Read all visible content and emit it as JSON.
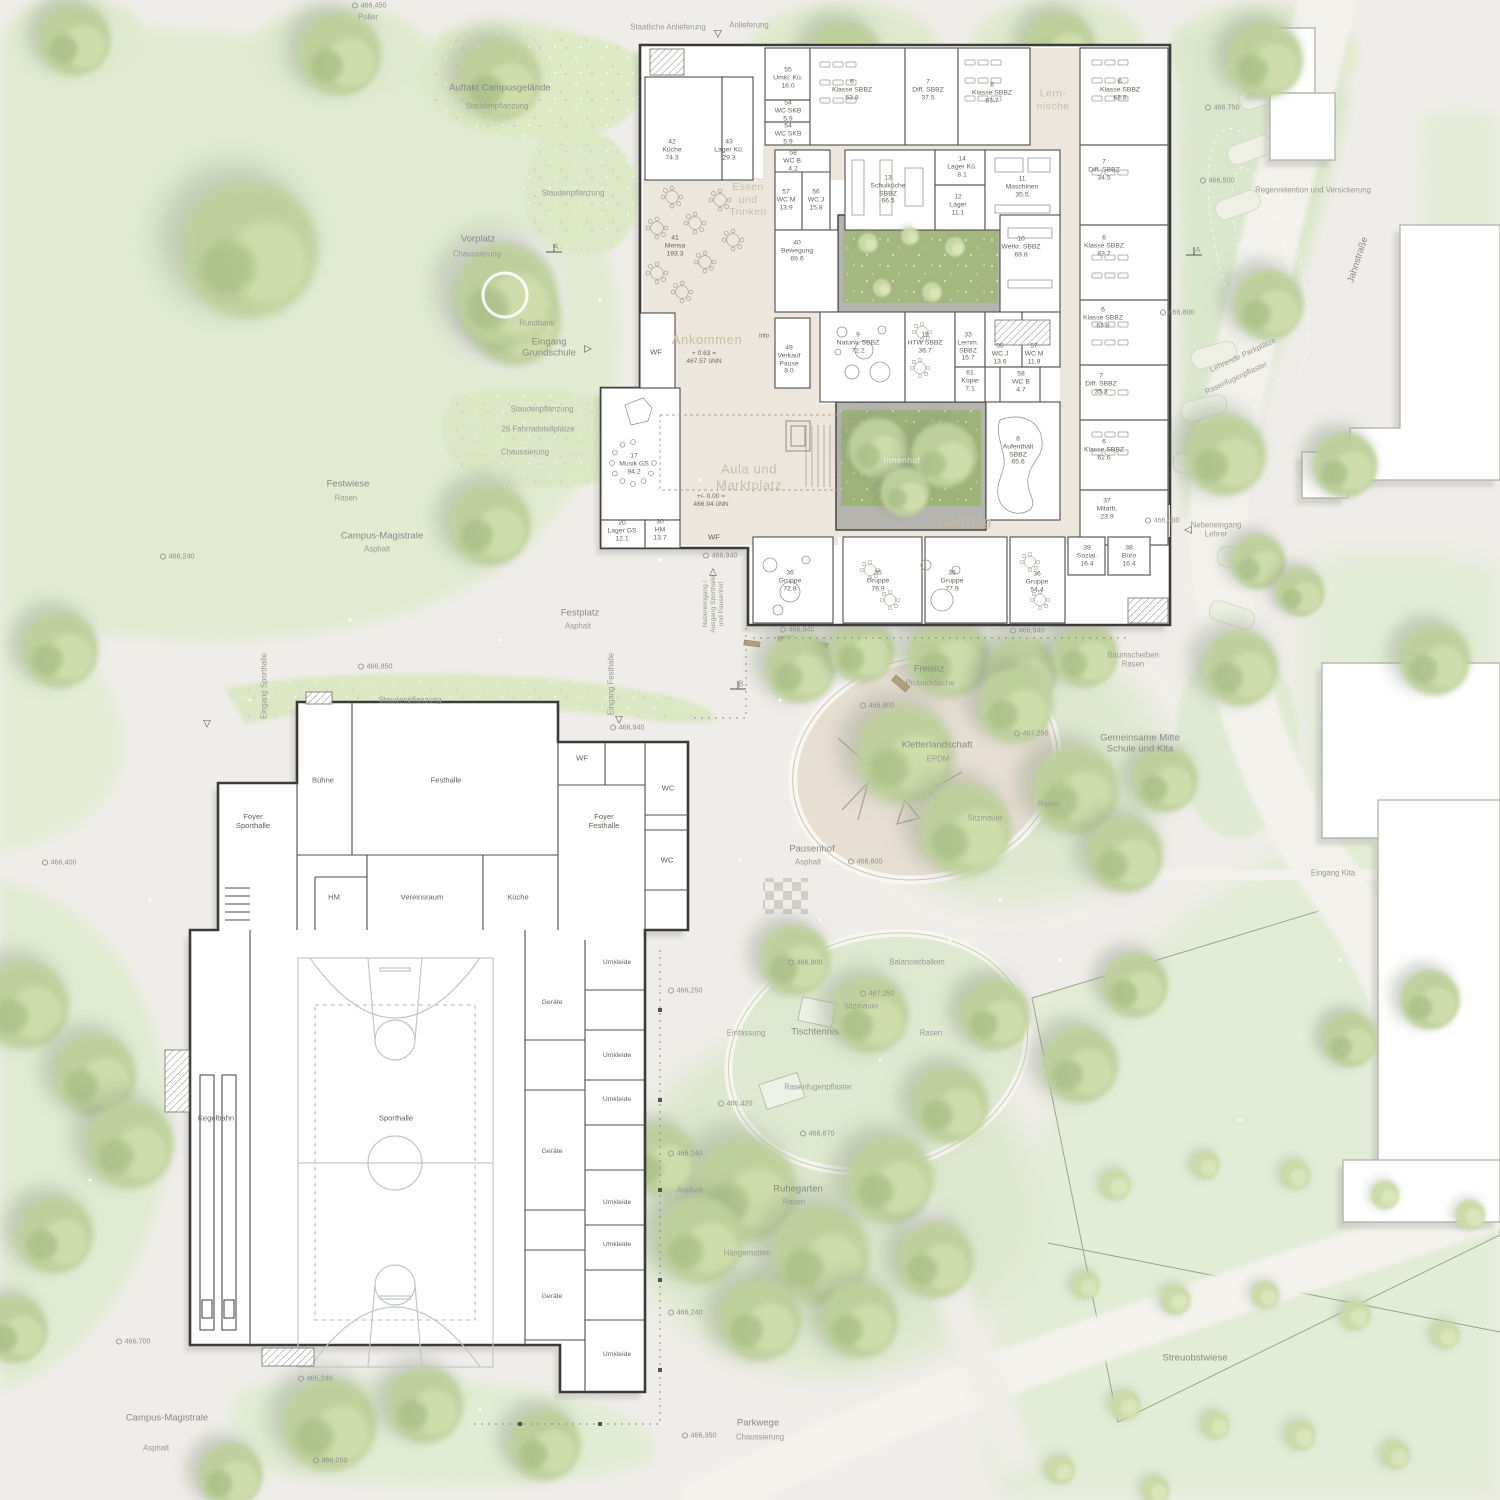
{
  "palette": {
    "paving": "#efede9",
    "lawn": "#e2ebd0",
    "tree": "#bfd19d",
    "wall": "#3b3b39",
    "circulation_beige": "#ece6dd",
    "courtyard_green": "#a3b87f",
    "play_sand": "#e7dfd2",
    "accent_zone_text": "#c9bda4"
  },
  "school": {
    "zones": {
      "lernnische": "Lern-\nnische",
      "essen": "Essen\nund\nTrinken",
      "ankommen": "Ankommen",
      "ankommen_level": "+ 0.63 =\n467.57 üNN",
      "aula": "Aula und\nMarktplatz",
      "aula_level": "+/- 0.00 =\n466.94 üNN",
      "innenhof": "Innenhof",
      "ganztag": "Ganztag"
    },
    "rooms": {
      "umkl_kue": "55\nUmkl. Kü.\n16.0",
      "wc_skb_a": "54\nWC SKB\n5.9",
      "wc_skb_b": "54\nWC SKB\n5.9",
      "klasse_n1": "6\nKlasse SBBZ\n63.8",
      "diff_n": "7\nDiff. SBBZ\n37.5",
      "klasse_n2": "6\nKlasse SBBZ\n63.7",
      "klasse_e1": "6\nKlasse SBBZ\n63.8",
      "kueche": "42\nKüche\n74.3",
      "lager_kue": "43\nLager Kü.\n29.3",
      "wc_b1": "58\nWC B.\n4.2",
      "wc_m1": "57\nWC M\n13.9",
      "wc_j1": "56\nWC J\n15.8",
      "schulkueche": "13\nSchulküche\nSBBZ\n66.5",
      "lager_kue2": "14\nLager Kü.\n8.1",
      "lager": "12\nLager\n11.1",
      "maschinen": "11\nMaschinen\n35.5",
      "diff_e1": "7\nDiff. SBBZ\n34.5",
      "mensa": "41\nMensa\n193.3",
      "bewegung": "40\nBewegung\n69.6",
      "werkraum": "10\nWerkr. SBBZ\n69.8",
      "klasse_e2": "6\nKlasse SBBZ\n63.7",
      "klasse_e3": "6\nKlasse SBBZ\n63.8",
      "verkauf": "49\nVerkauf\nPause\n8.0",
      "info": "Info",
      "naturw": "9\nNaturw. SBBZ\n72.2",
      "htw": "15\nHTW SBBZ\n36.7",
      "lernmittel": "33\nLernm.\nSBBZ\n15.7",
      "wc_j2": "56\nWC J\n13.6",
      "wc_m2": "57\nWC M\n11.9",
      "kopie": "61\nKopie\n7.1",
      "wc_b2": "58\nWC B\n4.7",
      "aufenthalt": "8\nAufenthalt\nSBBZ\n65.6",
      "musik": "17\nMusik GS\n94.2",
      "lager_gs": "20\nLager GS\n12.1",
      "hm": "30\nHM\n13.7",
      "diff_e2": "7\nDiff. SBBZ\n35.3",
      "klasse_e4": "6\nKlasse SBBZ\n62.6",
      "mitarbeiter": "37\nMitarb.\n23.9",
      "gruppe1": "36\nGruppe\n72.8",
      "gruppe2": "35\nGruppe\n76.9",
      "gruppe3": "36\nGruppe\n77.9",
      "gruppe4": "36\nGruppe\n54.4",
      "sozial": "39\nSozial.\n16.4",
      "buero": "38\nBüro\n16.4",
      "wf_a": "WF",
      "wf_b": "WF"
    }
  },
  "sports": {
    "rooms": {
      "buehne": "Bühne",
      "festhalle": "Festhalle",
      "foyer_sporthalle": "Foyer\nSporthalle",
      "foyer_festhalle": "Foyer\nFesthalle",
      "wf": "WF",
      "wc1": "WC",
      "wc2": "WC",
      "hm": "HM",
      "vereinsraum": "Vereinsraum",
      "kueche": "Küche",
      "kegelbahn": "Kegelbahn",
      "sporthalle": "Sporthalle",
      "geraete1": "Geräte",
      "geraete2": "Geräte",
      "geraete3": "Geräte",
      "umkleide1": "Umkleide",
      "umkleide2": "Umkleide",
      "umkleide3": "Umkleide",
      "umkleide4": "Umkleide",
      "umkleide5": "Umkleide",
      "umkleide6": "Umkleide",
      "asphalt_side": "Asphalt"
    }
  },
  "site": {
    "poller": "Poller",
    "auftakt": "Auftakt Campusgelände",
    "auftakt_sub": "Staudenpflanzung",
    "staatliche_anlieferung": "Staatliche Anlieferung",
    "anlieferung": "Anlieferung",
    "staudenpflanzung1": "Staudenpflanzung",
    "vorplatz": "Vorplatz",
    "vorplatz_sub": "Chaussierung",
    "rundbank": "Rundbank",
    "eingang_grundschule": "Eingang\nGrundschule",
    "staudenpflanzung2": "Staudenpflanzung",
    "fahrradstellplaetze": "26 Fahrradstellplätze",
    "chaussierung": "Chaussierung",
    "festwiese": "Festwiese",
    "festwiese_sub": "Rasen",
    "campus_magistrale1": "Campus-Magistrale",
    "campus_magistrale1_sub": "Asphalt",
    "eingang_sporthalle": "Eingang Sporthalle",
    "eingang_festhalle": "Eingang Festhalle",
    "festplatz": "Festplatz",
    "festplatz_sub": "Asphalt",
    "staudenpflanzung3": "Staudenpflanzung",
    "nebeneingang_sporthalle": "Nebeneingang /\nAusgang Sporthalle\nund Pausenhof",
    "freisitz": "Freisitz",
    "freisitz_sub": "Picknicktische",
    "kletterlandschaft": "Kletterlandschaft",
    "kletterlandschaft_sub": "EPDM",
    "pausenhof": "Pausenhof",
    "pausenhof_sub": "Asphalt",
    "sitzmauer1": "Sitzmauer",
    "sitzmauer2": "Sitzmauer",
    "rasen1": "Rasen",
    "rasen2": "Rasen",
    "baumscheiben": "Baumscheiben\nRasen",
    "gemeinsame_mitte": "Gemeinsame Mitte\nSchule und Kita",
    "balancierbalken": "Balancierbalken",
    "einfassung": "Einfassung",
    "tischtennis": "Tischtennis",
    "rasenfugenpflaster1": "Rasenfugenpflaster",
    "ruhegarten": "Ruhegarten",
    "ruhegarten_sub": "Rasen",
    "haengematten": "Hängematten",
    "streuobstwiese": "Streuobstwiese",
    "parkwege": "Parkwege",
    "parkwege_sub": "Chaussierung",
    "campus_magistrale2": "Campus-Magistrale",
    "campus_magistrale2_sub": "Asphalt",
    "regenretention": "Regenretention und Versickerung",
    "jahnstrasse": "Jahnstraße",
    "lehrende_parkplaetze": "Lehrende Parkplätze",
    "rasenfugenpflaster2": "Rasenfugenpflaster",
    "nebeneingang_lehrer": "Nebeneingang\nLehrer",
    "eingang_kita": "Eingang Kita",
    "section_a1": "A",
    "section_a2": "A",
    "section_b": "B"
  },
  "markers": [
    "466,450",
    "466,750",
    "466,500",
    "466,800",
    "466,240",
    "466,400",
    "466,850",
    "466,940",
    "466,940",
    "466,940",
    "466,940",
    "466,800",
    "467,250",
    "466,800",
    "466,800",
    "467,250",
    "466,420",
    "466,870",
    "466,250",
    "466,240",
    "466,240",
    "466,240",
    "466,700",
    "466,050",
    "466,350",
    "466,800"
  ],
  "icons": {
    "arrow_down": "▽",
    "arrow_up": "△",
    "arrow_right": "▷",
    "arrow_left": "◁"
  }
}
